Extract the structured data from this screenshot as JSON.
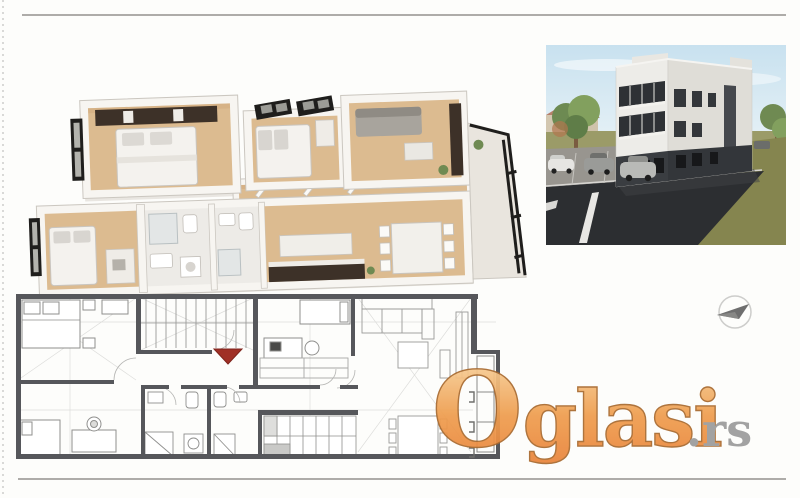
{
  "watermark": {
    "initial": "O",
    "rest": "glasi",
    "tld": ".rs"
  },
  "figures": {
    "floorplan_3d": "3D rendered apartment floor plan",
    "building_render": "3D exterior render of three-story residential building with parking",
    "floorplan_2d": "2D architectural apartment floor plan with entrance arrow",
    "north_arrow": "compass north arrow"
  },
  "colors": {
    "page_bg": "#fdfdfb",
    "rule": "#aeaca9",
    "edge_dots": "#d9d9d7",
    "wood": "#dcbb90",
    "wood_dark": "#cfa87a",
    "wall": "#f7f5f1",
    "wall_edge": "#c9c5bf",
    "wall_shadow": "#e0dcd5",
    "frame_black": "#1f1e1c",
    "bath_floor": "#edebe7",
    "furn_dark": "#3d3128",
    "sofa_gray": "#a8a49d",
    "plan_wall": "#56575b",
    "plan_line": "#c7c7c5",
    "plan_furn": "#8f8f8d",
    "arrow_red": "#a03026",
    "sky_top": "#c8e1ef",
    "sky_bottom": "#edf5f8",
    "bld_front": "#edece8",
    "bld_side": "#dfddd7",
    "bld_dark": "#3a3d41",
    "glass_dark": "#2e3135",
    "asphalt_dark": "#2c2e31",
    "asphalt_light": "#98958f",
    "grass": "#85854f",
    "tree": "#6f8a52",
    "compass": "#5e5e5e",
    "wm_g1": "#f9dcab",
    "wm_g2": "#ef9d4e",
    "wm_g3": "#e88038",
    "wm_stroke": "#a96a2f",
    "wm_tld": "#9c9c9c"
  }
}
